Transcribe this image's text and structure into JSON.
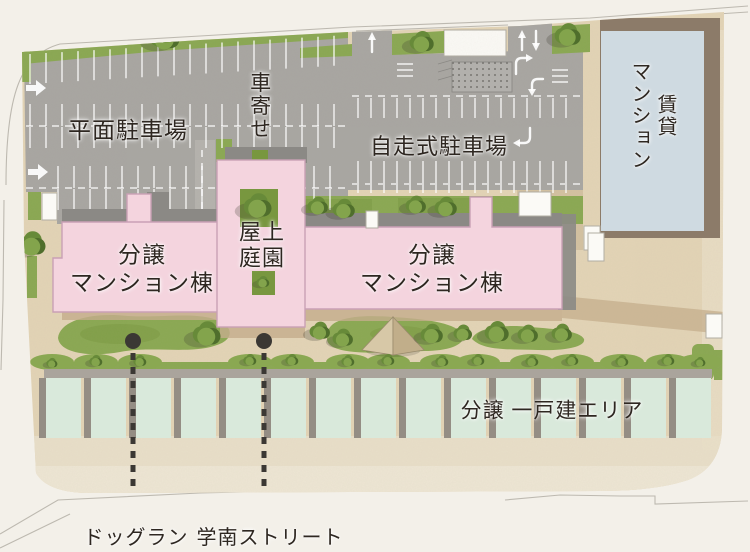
{
  "labels": {
    "flat_parking": "平面駐車場",
    "carport": "車寄せ",
    "self_parking": "自走式駐車場",
    "rental_mansion": "賃貸\nマンション",
    "condo_left": "分譲\nマンション棟",
    "rooftop_garden": "屋上\n庭園",
    "condo_right": "分譲\nマンション棟",
    "detached_area": "分譲 一戸建エリア",
    "dog_run": "ドッグラン",
    "street": "学南ストリート"
  },
  "colors": {
    "bg": "#f3f0e9",
    "site": "#e3d4b6",
    "walkway": "#e9dfc9",
    "walkway_light": "#eee6d4",
    "parking": "#a8a6a2",
    "parking_light": "#bdbbb7",
    "roof_gray": "#8b8985",
    "pink": "#f4d4de",
    "pink_line": "#c9a0b5",
    "lawn": "#8aa852",
    "lawn_dark": "#78973f",
    "tree_dark": "#4f6e2c",
    "tree_mid": "#678a39",
    "tree_light": "#83a44c",
    "tree_shadow": "#3c3c30",
    "mint": "#d9e9db",
    "house_shadow": "#948d84",
    "house_band": "#aaa49c",
    "mansion": "#cfdae1",
    "mansion_roof": "#8c7b69",
    "shadow_tan": "#c4ad8c",
    "white": "#fbfaf6",
    "edge": "#b1ada3",
    "road_line": "#bdb9b0",
    "ink": "#2e2721",
    "leader": "#3b3834"
  },
  "map": {
    "trees_large": [
      {
        "x": 165,
        "y": 37,
        "s": 16
      },
      {
        "x": 422,
        "y": 42,
        "s": 13
      },
      {
        "x": 568,
        "y": 35,
        "s": 14
      },
      {
        "x": 32,
        "y": 244,
        "s": 15
      },
      {
        "x": 318,
        "y": 206,
        "s": 11
      },
      {
        "x": 344,
        "y": 209,
        "s": 12
      },
      {
        "x": 416,
        "y": 205,
        "s": 11
      },
      {
        "x": 446,
        "y": 207,
        "s": 12
      },
      {
        "x": 258,
        "y": 206,
        "s": 15
      },
      {
        "x": 263,
        "y": 282,
        "s": 7
      },
      {
        "x": 207,
        "y": 334,
        "s": 15
      },
      {
        "x": 320,
        "y": 331,
        "s": 11
      },
      {
        "x": 343,
        "y": 338,
        "s": 11
      },
      {
        "x": 432,
        "y": 334,
        "s": 12
      },
      {
        "x": 463,
        "y": 333,
        "s": 10
      },
      {
        "x": 497,
        "y": 332,
        "s": 13
      },
      {
        "x": 528,
        "y": 334,
        "s": 11
      },
      {
        "x": 562,
        "y": 333,
        "s": 11
      }
    ],
    "trees_small": [
      {
        "x": 52,
        "y": 363,
        "s": 6
      },
      {
        "x": 96,
        "y": 361,
        "s": 7
      },
      {
        "x": 140,
        "y": 361,
        "s": 7
      },
      {
        "x": 250,
        "y": 360,
        "s": 7
      },
      {
        "x": 292,
        "y": 360,
        "s": 7
      },
      {
        "x": 348,
        "y": 361,
        "s": 7
      },
      {
        "x": 388,
        "y": 360,
        "s": 7
      },
      {
        "x": 442,
        "y": 361,
        "s": 7
      },
      {
        "x": 478,
        "y": 360,
        "s": 7
      },
      {
        "x": 532,
        "y": 361,
        "s": 7
      },
      {
        "x": 572,
        "y": 360,
        "s": 7
      },
      {
        "x": 622,
        "y": 361,
        "s": 7
      },
      {
        "x": 668,
        "y": 360,
        "s": 7
      },
      {
        "x": 700,
        "y": 362,
        "s": 6
      }
    ],
    "houses": {
      "count": 15,
      "x0": 46,
      "pitch": 45,
      "width": 35,
      "y": 378,
      "height": 60
    },
    "leaders": [
      {
        "x": 133,
        "dot_y": 341,
        "line_y1": 353,
        "line_y2": 522
      },
      {
        "x": 264,
        "dot_y": 341,
        "line_y1": 353,
        "line_y2": 522
      }
    ]
  }
}
